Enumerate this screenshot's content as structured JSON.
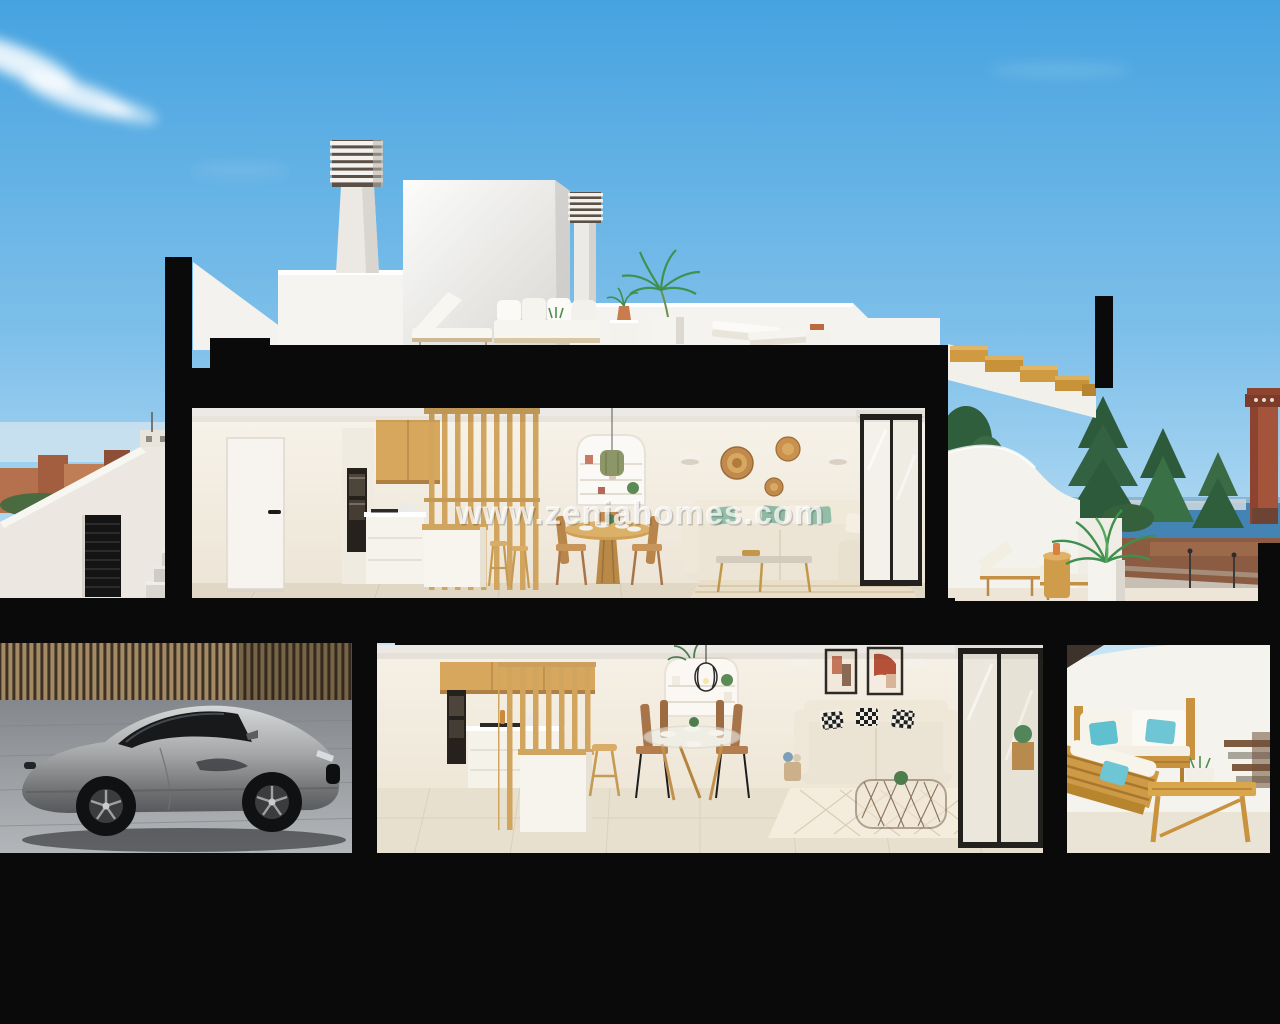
{
  "watermark": {
    "text": "www.zeniahomes.com"
  },
  "scene": {
    "setting": "cutaway-3d-render-two-storey-villa",
    "objects": [
      "sky",
      "clouds",
      "town-skyline-left",
      "sea-horizon-right",
      "conifer-trees",
      "watchtower",
      "penthouse-volume",
      "ventilation-chimneys",
      "roof-terrace-furniture",
      "exterior-staircase",
      "upper-floor-kitchen",
      "upper-floor-dining",
      "upper-floor-living-room",
      "upper-floor-terrace-sunloungers",
      "interior-wood-staircase",
      "garage-sports-car",
      "wood-slat-fence",
      "ground-floor-kitchen",
      "ground-floor-dining",
      "ground-floor-living-room",
      "ground-floor-patio-wood-sofas"
    ],
    "palette": {
      "sky_top": "#46a3e0",
      "sky_low": "#c2e2f4",
      "structure_black": "#0a0a0a",
      "wall_white": "#f4f2ec",
      "wood": "#cf9c4b",
      "interior_wall": "#f2ece1",
      "tile_floor": "#e3dac7",
      "sofa_beige": "#ebe3d3",
      "pillow_green": "#93bda6",
      "pillow_teal": "#5fc0cf",
      "car_silver": "#9b9da0",
      "sea": "#4384b4",
      "terrain": "#8b5c42",
      "tree_green": "#2d5a3a"
    }
  }
}
